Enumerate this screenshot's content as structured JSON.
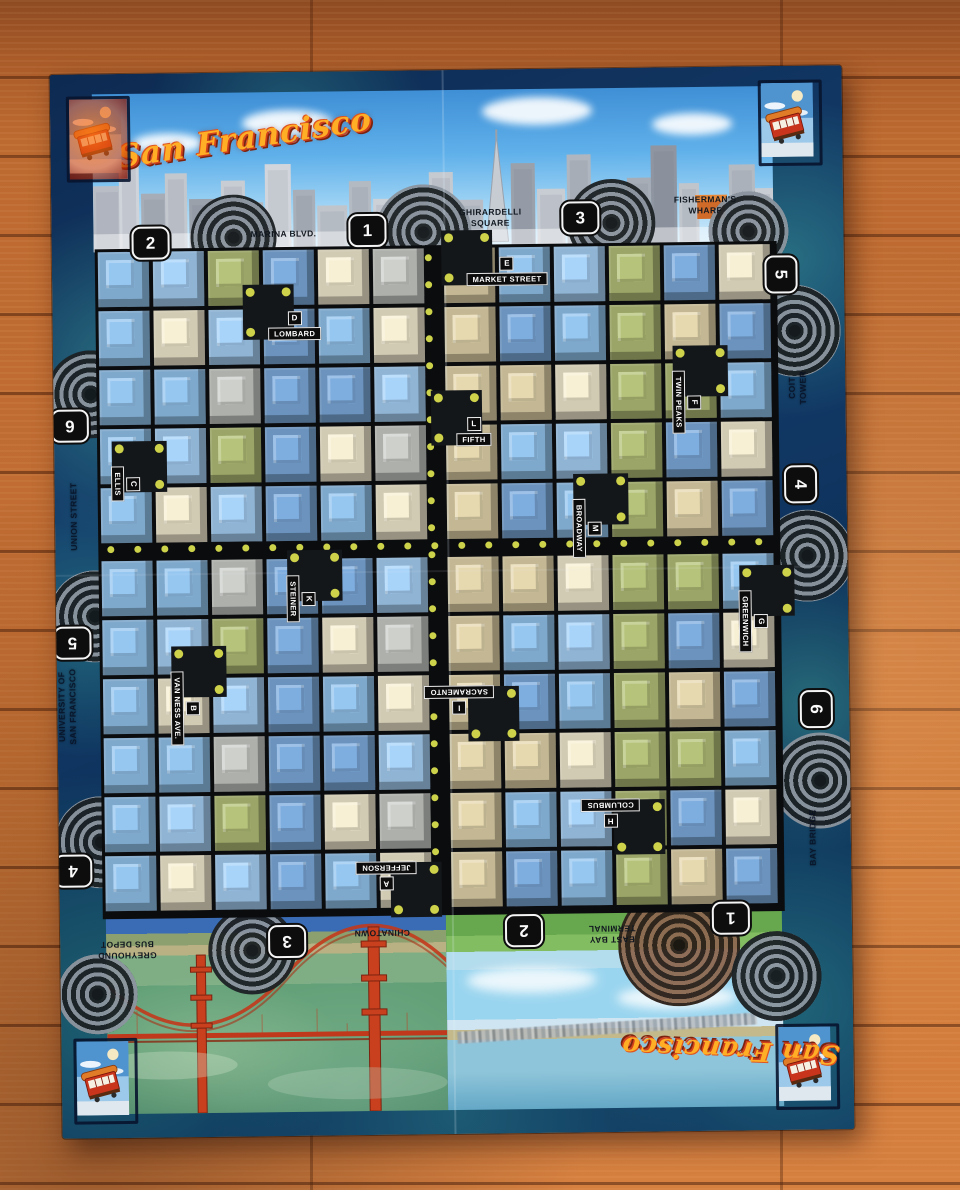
{
  "titles": {
    "top": "San Francisco",
    "bottom": "San Francisco"
  },
  "stations": [
    {
      "n": "2",
      "side": "top"
    },
    {
      "n": "1",
      "side": "top"
    },
    {
      "n": "3",
      "side": "top"
    },
    {
      "n": "5",
      "side": "right"
    },
    {
      "n": "4",
      "side": "right"
    },
    {
      "n": "6",
      "side": "right"
    },
    {
      "n": "6",
      "side": "left"
    },
    {
      "n": "5",
      "side": "left"
    },
    {
      "n": "4",
      "side": "left"
    },
    {
      "n": "3",
      "side": "bottom"
    },
    {
      "n": "2",
      "side": "bottom"
    },
    {
      "n": "1",
      "side": "bottom"
    }
  ],
  "destinations": [
    {
      "lines": [
        "MARINA BLVD."
      ],
      "side": "top"
    },
    {
      "lines": [
        "GHIRARDELLI",
        "SQUARE"
      ],
      "side": "top"
    },
    {
      "lines": [
        "FISHERMAN'S",
        "WHARF"
      ],
      "side": "top"
    },
    {
      "lines": [
        "COIT",
        "TOWER"
      ],
      "side": "right"
    },
    {
      "lines": [
        "BAY BRIDGE"
      ],
      "side": "right"
    },
    {
      "lines": [
        "UNION STREET"
      ],
      "side": "left"
    },
    {
      "lines": [
        "UNIVERSITY OF",
        "SAN FRANCISCO"
      ],
      "side": "left"
    },
    {
      "lines": [
        "GREYHOUND",
        "BUS DEPOT"
      ],
      "side": "bottom"
    },
    {
      "lines": [
        "CHINATOWN"
      ],
      "side": "bottom"
    },
    {
      "lines": [
        "EAST BAY",
        "TERMINAL"
      ],
      "side": "bottom"
    }
  ],
  "stops": [
    {
      "letter": "D",
      "name": "LOMBARD",
      "dir": "h"
    },
    {
      "letter": "E",
      "name": "MARKET STREET",
      "dir": "h"
    },
    {
      "letter": "L",
      "name": "FIFTH",
      "dir": "h"
    },
    {
      "letter": "C",
      "name": "ELLIS",
      "dir": "v"
    },
    {
      "letter": "K",
      "name": "STEINER",
      "dir": "v"
    },
    {
      "letter": "M",
      "name": "BROADWAY",
      "dir": "v"
    },
    {
      "letter": "B",
      "name": "VAN NESS AVE.",
      "dir": "v"
    },
    {
      "letter": "F",
      "name": "TWIN PEAKS",
      "dir": "v"
    },
    {
      "letter": "G",
      "name": "GREENWICH",
      "dir": "v"
    },
    {
      "letter": "I",
      "name": "SACRAMENTO",
      "dir": "u"
    },
    {
      "letter": "H",
      "name": "COLUMBUS",
      "dir": "u"
    },
    {
      "letter": "A",
      "name": "JEFFERSON",
      "dir": "u"
    }
  ],
  "colors": {
    "title_orange": "#ffae26",
    "title_outline": "#d2411c",
    "water_dark": "#0d2a52",
    "water_teal": "#46b4a0",
    "street_black": "#0b0c0e",
    "tree_dot": "#cdd24a",
    "loop_gray": "#8b949e",
    "loop_brown": "#8d6a52",
    "bridge_red": "#c23a1c",
    "sky_blue": "#5fb0ea",
    "grass_green": "#67a84e"
  },
  "block_palette": [
    "#7fa9cc",
    "#6b93bd",
    "#c4b894",
    "#9aa567",
    "#aeb0ac",
    "#8fb4d4",
    "#d2cbb4"
  ]
}
